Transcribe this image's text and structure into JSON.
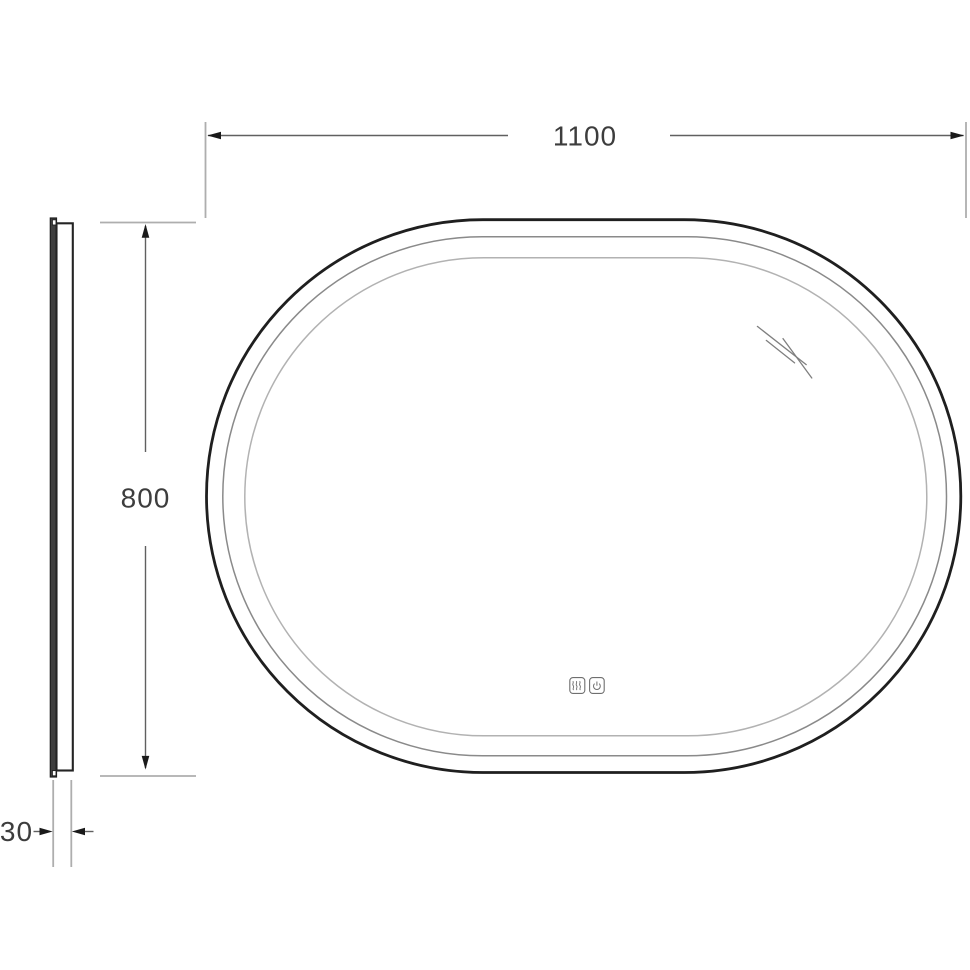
{
  "drawing": {
    "subject": "oval mirror technical drawing, front and side views",
    "dimension_width": "1100",
    "dimension_height": "800",
    "dimension_depth": "30",
    "icons": [
      "anti-fog-icon",
      "power-icon"
    ],
    "colors": {
      "background": "#ffffff",
      "outline_dark": "#1f1f1f",
      "frame_mid_line": "#8a8a8a",
      "inner_light_line": "#b2b2b2",
      "dimension_line": "#606060",
      "extension_line": "#aeaeae",
      "arrow_fill": "#1a1a1a",
      "label_text": "#3d3d3d",
      "icon_line": "#6f6f6f",
      "reflection_line": "#7f7f7f"
    }
  }
}
